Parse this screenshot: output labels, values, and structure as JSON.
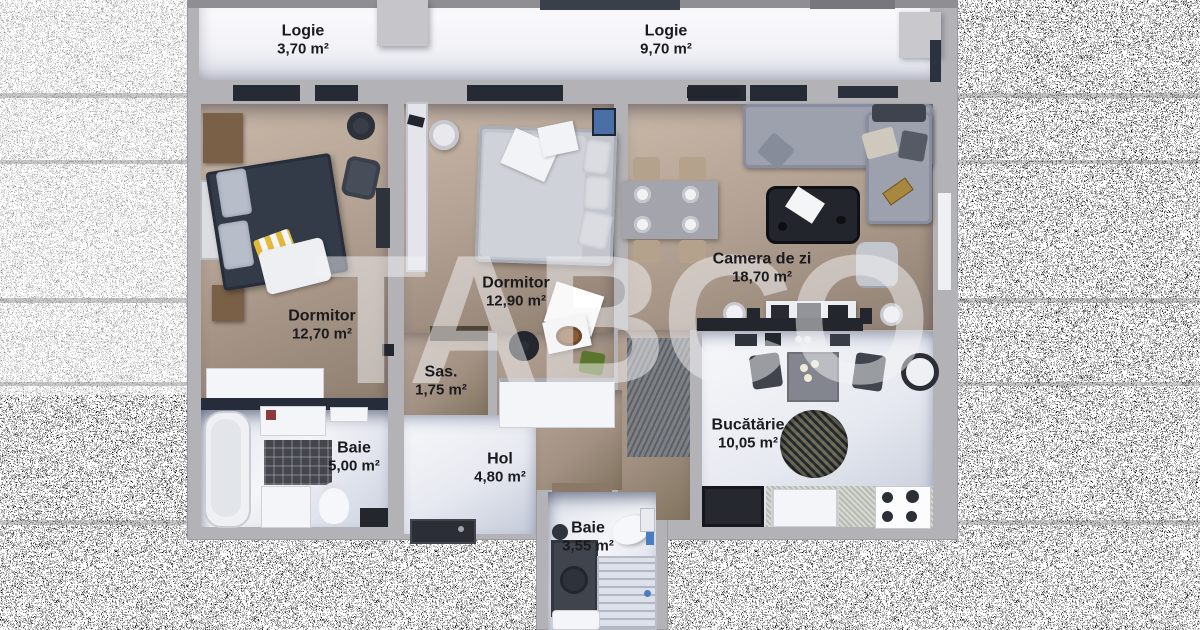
{
  "watermark": {
    "text": "TABCO"
  },
  "rooms": [
    {
      "id": "logie-1",
      "name": "Logie",
      "area": "3,70 m²"
    },
    {
      "id": "logie-2",
      "name": "Logie",
      "area": "9,70 m²"
    },
    {
      "id": "dormitor-1",
      "name": "Dormitor",
      "area": "12,70 m²"
    },
    {
      "id": "dormitor-2",
      "name": "Dormitor",
      "area": "12,90 m²"
    },
    {
      "id": "camera-de-zi",
      "name": "Camera de zi",
      "area": "18,70 m²"
    },
    {
      "id": "sas",
      "name": "Sas.",
      "area": "1,75 m²"
    },
    {
      "id": "baie-1",
      "name": "Baie",
      "area": "5,00 m²"
    },
    {
      "id": "hol",
      "name": "Hol",
      "area": "4,80 m²"
    },
    {
      "id": "bucatarie",
      "name": "Bucătărie",
      "area": "10,05 m²"
    },
    {
      "id": "baie-2",
      "name": "Baie",
      "area": "3,55 m²"
    }
  ],
  "colors": {
    "wall": "#b3b3b7",
    "floor_tan": "#b3a293",
    "floor_light": "#e6e9f0",
    "window_dark": "#252a34",
    "label_text": "#1b1b1f",
    "watermark": "rgba(243,243,246,0.5)"
  }
}
